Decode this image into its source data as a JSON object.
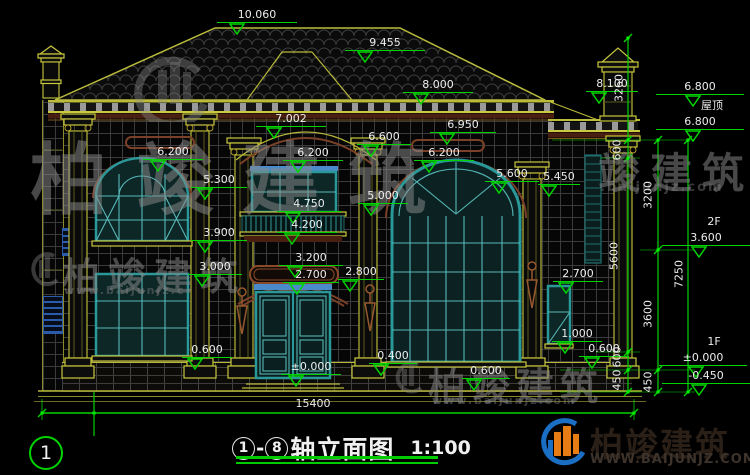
{
  "title": {
    "axis_start": "1",
    "dash": "-",
    "axis_end": "8",
    "name": "轴立面图",
    "scale": "1:100"
  },
  "overall_dim": {
    "label": "15400"
  },
  "axis_bubble": {
    "label": "1"
  },
  "right_floor_labels": [
    "屋顶",
    "2F",
    "1F"
  ],
  "elevation_markers": [
    {
      "t": "10.060",
      "x": 257,
      "y": 8,
      "w": 80
    },
    {
      "t": "9.455",
      "x": 385,
      "y": 36,
      "w": 80
    },
    {
      "t": "8.000",
      "x": 438,
      "y": 78,
      "w": 70
    },
    {
      "t": "8.100",
      "x": 612,
      "y": 77,
      "w": 52
    },
    {
      "t": "7.002",
      "x": 291,
      "y": 112,
      "w": 70
    },
    {
      "t": "6.950",
      "x": 463,
      "y": 118,
      "w": 66
    },
    {
      "t": "6.600",
      "x": 384,
      "y": 130,
      "w": 54
    },
    {
      "t": "6.200",
      "x": 173,
      "y": 145,
      "w": 60
    },
    {
      "t": "6.200",
      "x": 313,
      "y": 146,
      "w": 60
    },
    {
      "t": "6.200",
      "x": 444,
      "y": 146,
      "w": 60
    },
    {
      "t": "5.600",
      "x": 512,
      "y": 167,
      "w": 54
    },
    {
      "t": "5.450",
      "x": 559,
      "y": 170,
      "w": 42
    },
    {
      "t": "5.300",
      "x": 219,
      "y": 173,
      "w": 56
    },
    {
      "t": "5.000",
      "x": 383,
      "y": 189,
      "w": 50
    },
    {
      "t": "4.750",
      "x": 309,
      "y": 197,
      "w": 64
    },
    {
      "t": "4.200",
      "x": 307,
      "y": 218,
      "w": 60
    },
    {
      "t": "3.900",
      "x": 219,
      "y": 226,
      "w": 56
    },
    {
      "t": "3.200",
      "x": 311,
      "y": 251,
      "w": 64
    },
    {
      "t": "3.000",
      "x": 215,
      "y": 260,
      "w": 54
    },
    {
      "t": "2.800",
      "x": 361,
      "y": 265,
      "w": 46
    },
    {
      "t": "2.700",
      "x": 311,
      "y": 268,
      "w": 56
    },
    {
      "t": "2.700",
      "x": 578,
      "y": 267,
      "w": 50
    },
    {
      "t": "1.000",
      "x": 577,
      "y": 327,
      "w": 50
    },
    {
      "t": "0.600",
      "x": 207,
      "y": 343,
      "w": 50
    },
    {
      "t": "0.600",
      "x": 604,
      "y": 342,
      "w": 50
    },
    {
      "t": "0.600",
      "x": 486,
      "y": 364,
      "w": 48
    },
    {
      "t": "0.400",
      "x": 393,
      "y": 349,
      "w": 48
    },
    {
      "t": "±0.000",
      "x": 311,
      "y": 360,
      "w": 60
    }
  ],
  "right_labels": [
    {
      "t": "6.800",
      "x": 700,
      "y": 80,
      "w": 88
    },
    {
      "t": "屋顶",
      "x": 712,
      "y": 99,
      "w": 0
    },
    {
      "t": "6.800",
      "x": 700,
      "y": 115,
      "w": 88
    },
    {
      "t": "2F",
      "x": 714,
      "y": 215,
      "w": 0
    },
    {
      "t": "3.600",
      "x": 706,
      "y": 231,
      "w": 88
    },
    {
      "t": "1F",
      "x": 714,
      "y": 335,
      "w": 0
    },
    {
      "t": "±0.000",
      "x": 703,
      "y": 351,
      "w": 88
    },
    {
      "t": "-0.450",
      "x": 706,
      "y": 369,
      "w": 88
    }
  ],
  "vertical_dims": [
    {
      "t": "3260",
      "x": 619,
      "y": 88
    },
    {
      "t": "600",
      "x": 617,
      "y": 150
    },
    {
      "t": "5600",
      "x": 614,
      "y": 256
    },
    {
      "t": "600",
      "x": 617,
      "y": 357
    },
    {
      "t": "450",
      "x": 617,
      "y": 380
    },
    {
      "t": "3200",
      "x": 648,
      "y": 195
    },
    {
      "t": "3600",
      "x": 648,
      "y": 314
    },
    {
      "t": "450",
      "x": 648,
      "y": 382
    },
    {
      "t": "7250",
      "x": 679,
      "y": 274
    }
  ],
  "watermarks": {
    "brand": "柏竣建筑",
    "brand_right": "竣建筑",
    "url": "www.baijunjz.com",
    "url_left": "www.baijunjz.c",
    "url_right": ".baijunjz.com"
  },
  "logo": {
    "name": "柏竣建筑",
    "site": "WWW.BAIJUNJZ.COM"
  },
  "colors": {
    "dim_green": "#00d400",
    "line_yellow": "#c8c83c",
    "window_teal": "#2a9898",
    "trim_brown": "#7a4028",
    "logo_blue": "#1a6fc4",
    "logo_orange": "#e87c14"
  }
}
